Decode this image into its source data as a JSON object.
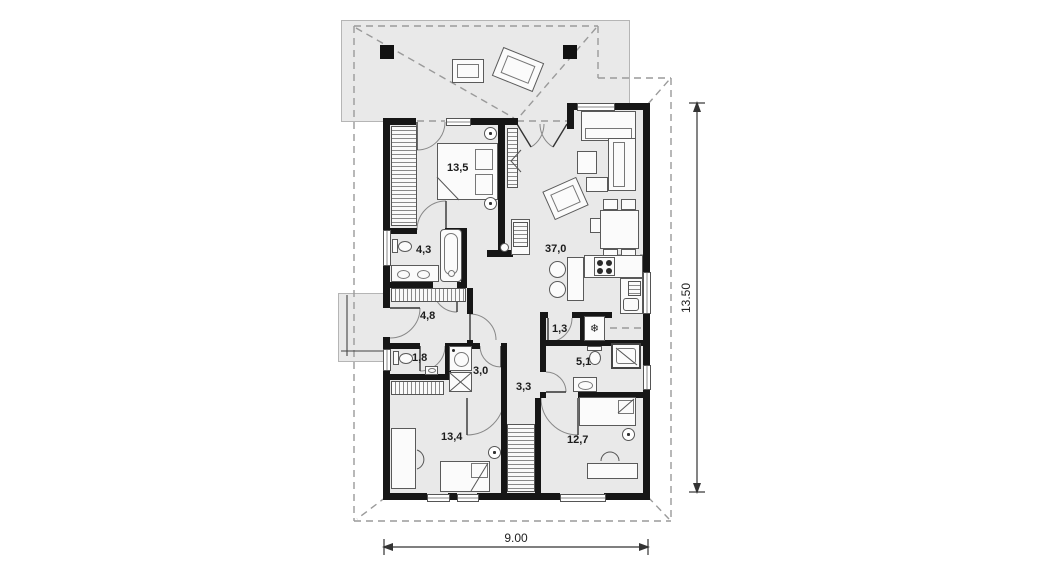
{
  "floor_plan": {
    "rooms": [
      {
        "name": "bedroom-main",
        "area": "13,5"
      },
      {
        "name": "bathroom-main",
        "area": "4,3"
      },
      {
        "name": "entrance-hall",
        "area": "4,8"
      },
      {
        "name": "wc",
        "area": "1,8"
      },
      {
        "name": "utility-room",
        "area": "3,0"
      },
      {
        "name": "pantry",
        "area": "1,3"
      },
      {
        "name": "inner-hall",
        "area": "3,3"
      },
      {
        "name": "bathroom-2",
        "area": "5,1"
      },
      {
        "name": "living-room-kitchen",
        "area": "37,0"
      },
      {
        "name": "bedroom-2",
        "area": "13,4"
      },
      {
        "name": "bedroom-3",
        "area": "12,7"
      }
    ],
    "dimensions": {
      "width": "9.00",
      "height": "13.50"
    },
    "icons": {
      "freezer": "❄"
    },
    "colors": {
      "wall": "#161616",
      "floor": "#e9e9e9",
      "furniture_line": "#5a5a5a",
      "roof_dash": "#9a9a9a"
    }
  }
}
